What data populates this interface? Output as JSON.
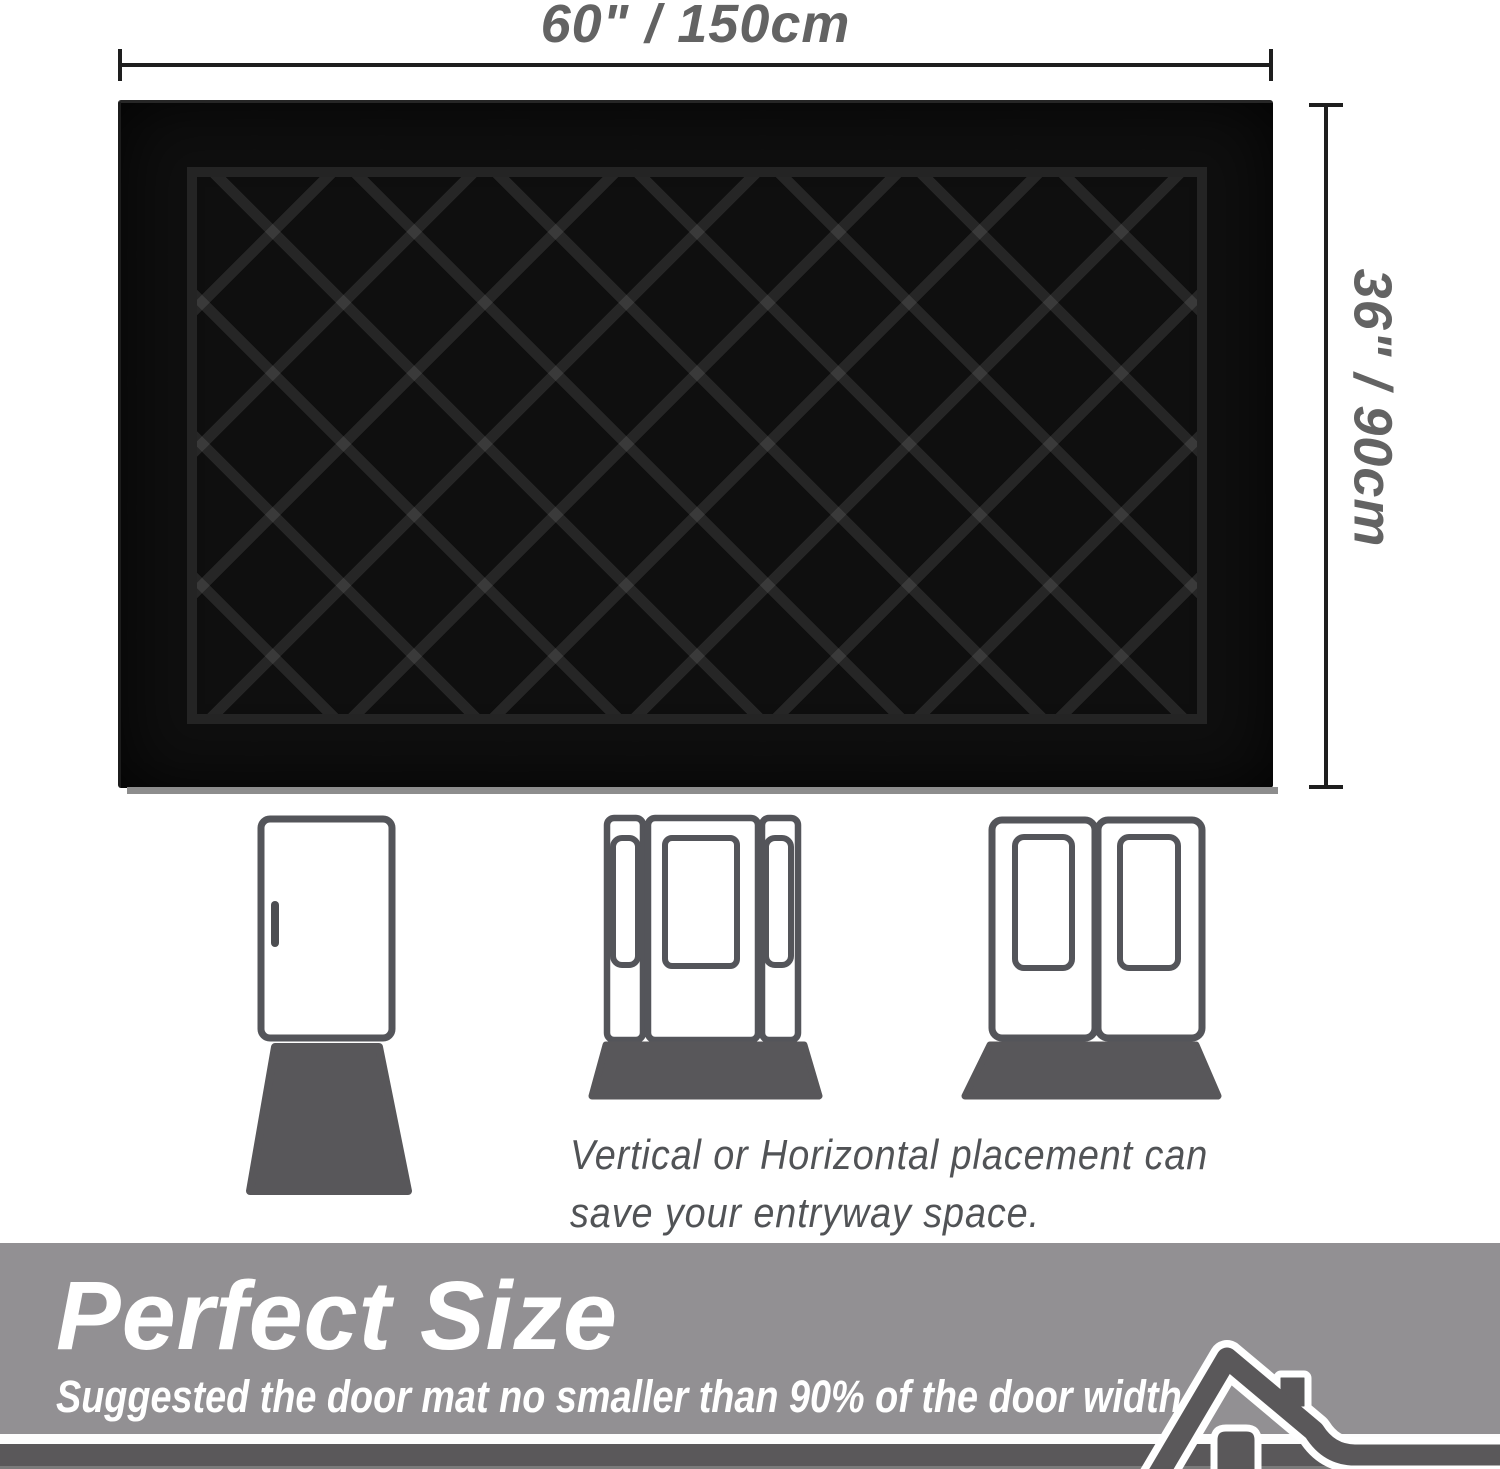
{
  "dimension_top": {
    "label": "60\" / 150cm"
  },
  "dimension_side": {
    "label": "36\" / 90cm"
  },
  "mat": {
    "description": "black diamond-lattice door mat",
    "pattern": "diamond-lattice"
  },
  "placement_section": {
    "caption_line1": "Vertical or Horizontal placement can",
    "caption_line2": "save your entryway space.",
    "doors": [
      "single-door",
      "door-with-sidelights",
      "double-door"
    ]
  },
  "banner": {
    "title": "Perfect Size",
    "subtitle": "Suggested the door mat no smaller than 90% of the door width."
  },
  "colors": {
    "banner_gray": "#929093",
    "banner_dark_band": "#5a585a",
    "illustration_gray": "#58575a",
    "mat_black": "#0f0f0f",
    "dimension_text_gray": "#636363"
  }
}
